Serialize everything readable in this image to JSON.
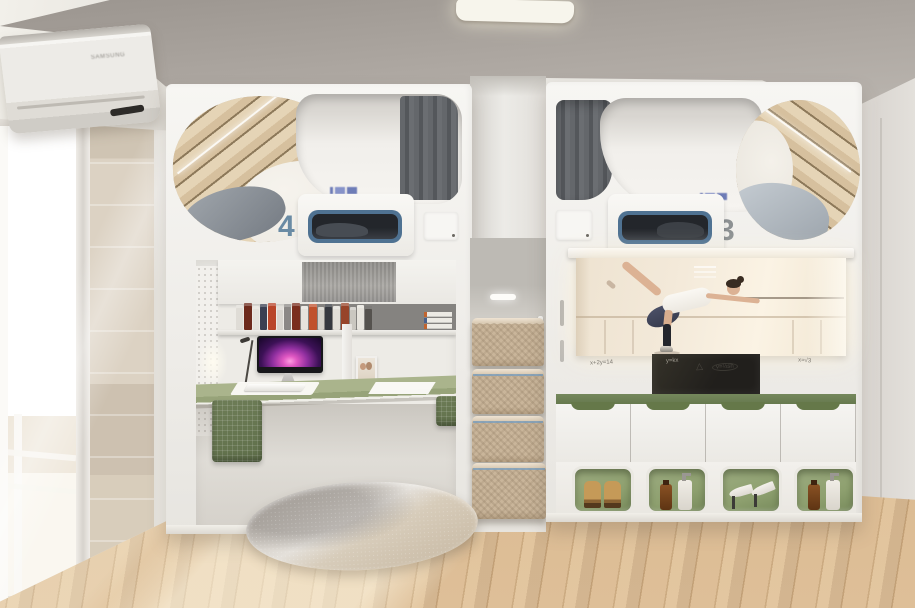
{
  "scene": {
    "type": "3d-interior-render",
    "description": "student dorm room with two white capsule loft beds, study desk, stair drawers, projector screen and shoe storage"
  },
  "ac_unit": {
    "brand": "SAMSUNG"
  },
  "bed_pods": {
    "left": {
      "number": "4",
      "features": [
        "wood-slat capsule ceiling",
        "gray pillow",
        "gray curtain",
        "blue-framed lower bunk window",
        "switch panel",
        "blue brand mark (illegible)"
      ]
    },
    "right": {
      "number": "3",
      "features": [
        "gray curtain",
        "wood-slat capsule ceiling",
        "light blue bedding",
        "blue-framed lower bunk window",
        "switch panel",
        "blue brand mark (illegible)"
      ]
    }
  },
  "desk_area": {
    "monitor": "desktop computer with purple aurora wallpaper",
    "accessories": [
      "keyboard",
      "desk mat",
      "photo frame",
      "desk lamp",
      "paper",
      "pegboard",
      "wire baskets"
    ],
    "book_spines": [
      {
        "c": "#dfdcd6",
        "h": 25,
        "w": 7
      },
      {
        "c": "#6d2a1c",
        "h": 27,
        "w": 8
      },
      {
        "c": "#e4e1da",
        "h": 24,
        "w": 6
      },
      {
        "c": "#3a3f52",
        "h": 26,
        "w": 7
      },
      {
        "c": "#b9452a",
        "h": 27,
        "w": 8
      },
      {
        "c": "#d8d5cf",
        "h": 23,
        "w": 6
      },
      {
        "c": "#8b8886",
        "h": 26,
        "w": 7
      },
      {
        "c": "#7a2d1d",
        "h": 27,
        "w": 8
      },
      {
        "c": "#e6e3dc",
        "h": 24,
        "w": 7
      },
      {
        "c": "#c0512c",
        "h": 26,
        "w": 8
      },
      {
        "c": "#d3d0c9",
        "h": 23,
        "w": 6
      },
      {
        "c": "#35383f",
        "h": 26,
        "w": 7
      },
      {
        "c": "#e2dfd8",
        "h": 24,
        "w": 7
      },
      {
        "c": "#97442a",
        "h": 27,
        "w": 8
      },
      {
        "c": "#cac7c0",
        "h": 23,
        "w": 6
      },
      {
        "c": "#e7e4dd",
        "h": 25,
        "w": 7
      },
      {
        "c": "#55524e",
        "h": 24,
        "w": 7
      }
    ],
    "stacked_books": 3
  },
  "stair_drawers": {
    "steps": 4,
    "material": "rattan-front wood drawers",
    "step_light": "LED bar"
  },
  "media_wall": {
    "screen_content": "ballet dancer in arabesque at barre in bright dance studio",
    "whiteboard_scribbles": [
      "x+2y=14",
      "△",
      "v=⅓sh",
      "x=√3",
      "y=kx"
    ],
    "tv": "dark wall panel behind screen"
  },
  "storage": {
    "cabinet_doors": 4,
    "cubbies": [
      "boots",
      "toiletry bottles",
      "high heels",
      "toiletry bottles"
    ]
  },
  "colors": {
    "wall": "#e9e7e2",
    "ceiling": "#aba59f",
    "pod_white": "#f4f3f0",
    "curtain_gray": "#64676b",
    "wood_slat": "#d6c09e",
    "number_blue": "#6a8ba4",
    "number_gray": "#8d9193",
    "window_frame_blue": "#4f7292",
    "desk_green": "#aab48c",
    "rail_green": "#75885c",
    "cubby_green": "#8ea06f",
    "basket_green": "#5f6f4a",
    "floor_wood": "#d7b58a",
    "screen_warm": "#f3e9d9",
    "step_wood": "#c9b59a"
  }
}
